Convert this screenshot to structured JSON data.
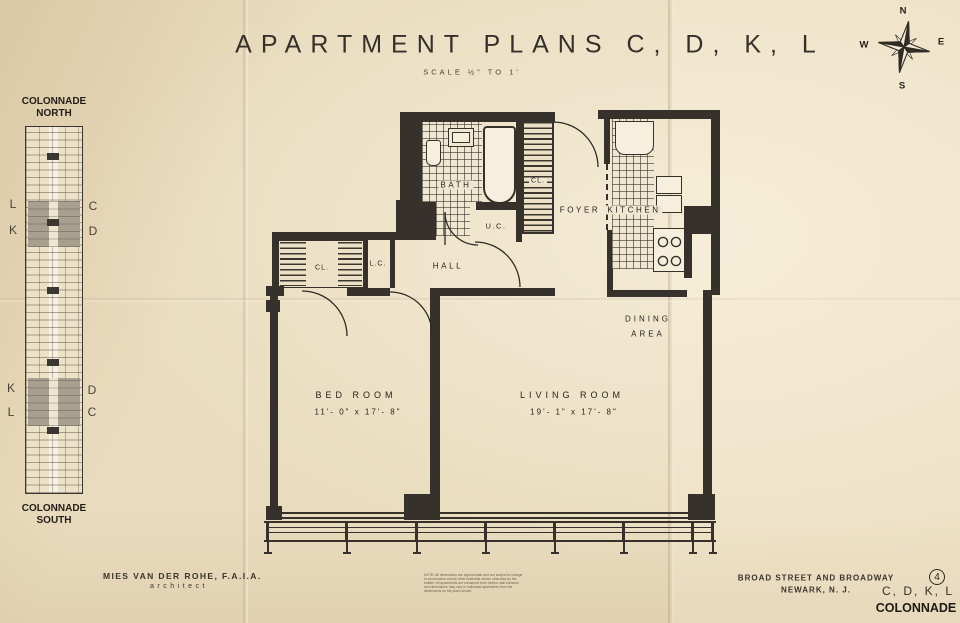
{
  "title": {
    "main": "APARTMENT PLANS C, D, K, L",
    "scale": "SCALE ½\" TO 1'"
  },
  "compass": {
    "north": "N",
    "south": "S",
    "east": "E",
    "west": "W"
  },
  "key_plan": {
    "north_title": "COLONNADE NORTH",
    "south_title": "COLONNADE SOUTH",
    "north_left_top": "L",
    "north_left_bottom": "K",
    "north_right_top": "C",
    "north_right_bottom": "D",
    "south_left_top": "K",
    "south_left_bottom": "L",
    "south_right_top": "D",
    "south_right_bottom": "C"
  },
  "plan_labels": {
    "bath": "BATH",
    "foyer_closet": "CL.",
    "utility_closet": "U.C.",
    "foyer": "FOYER",
    "kitchen": "KITCHEN",
    "hall_closet": "CL.",
    "linen_closet": "L.C.",
    "hall": "HALL",
    "dining_1": "DINING",
    "dining_2": "AREA",
    "bedroom_name": "BED ROOM",
    "bedroom_dims": "11'- 0\" x 17'- 8\"",
    "living_name": "LIVING ROOM",
    "living_dims": "19'- 1\"  x  17'- 8\""
  },
  "footer": {
    "architect": "MIES VAN DER ROHE, F.A.I.A.",
    "architect_role": "architect",
    "note_1": "NOTE: All dimensions are approximate and are subject to change",
    "note_2": "in construction and all other materials shown otherwise by the",
    "note_3": "builder. All apartments are measured from interior wall surfaces",
    "note_4": "and dimensions may vary in individual apartments from the",
    "note_5": "dimensions on the plans shown.",
    "address_1": "BROAD STREET AND BROADWAY",
    "address_2": "NEWARK, N. J.",
    "sheet_number": "4",
    "sheet_plans": "C, D, K, L",
    "building_name": "COLONNADE"
  }
}
